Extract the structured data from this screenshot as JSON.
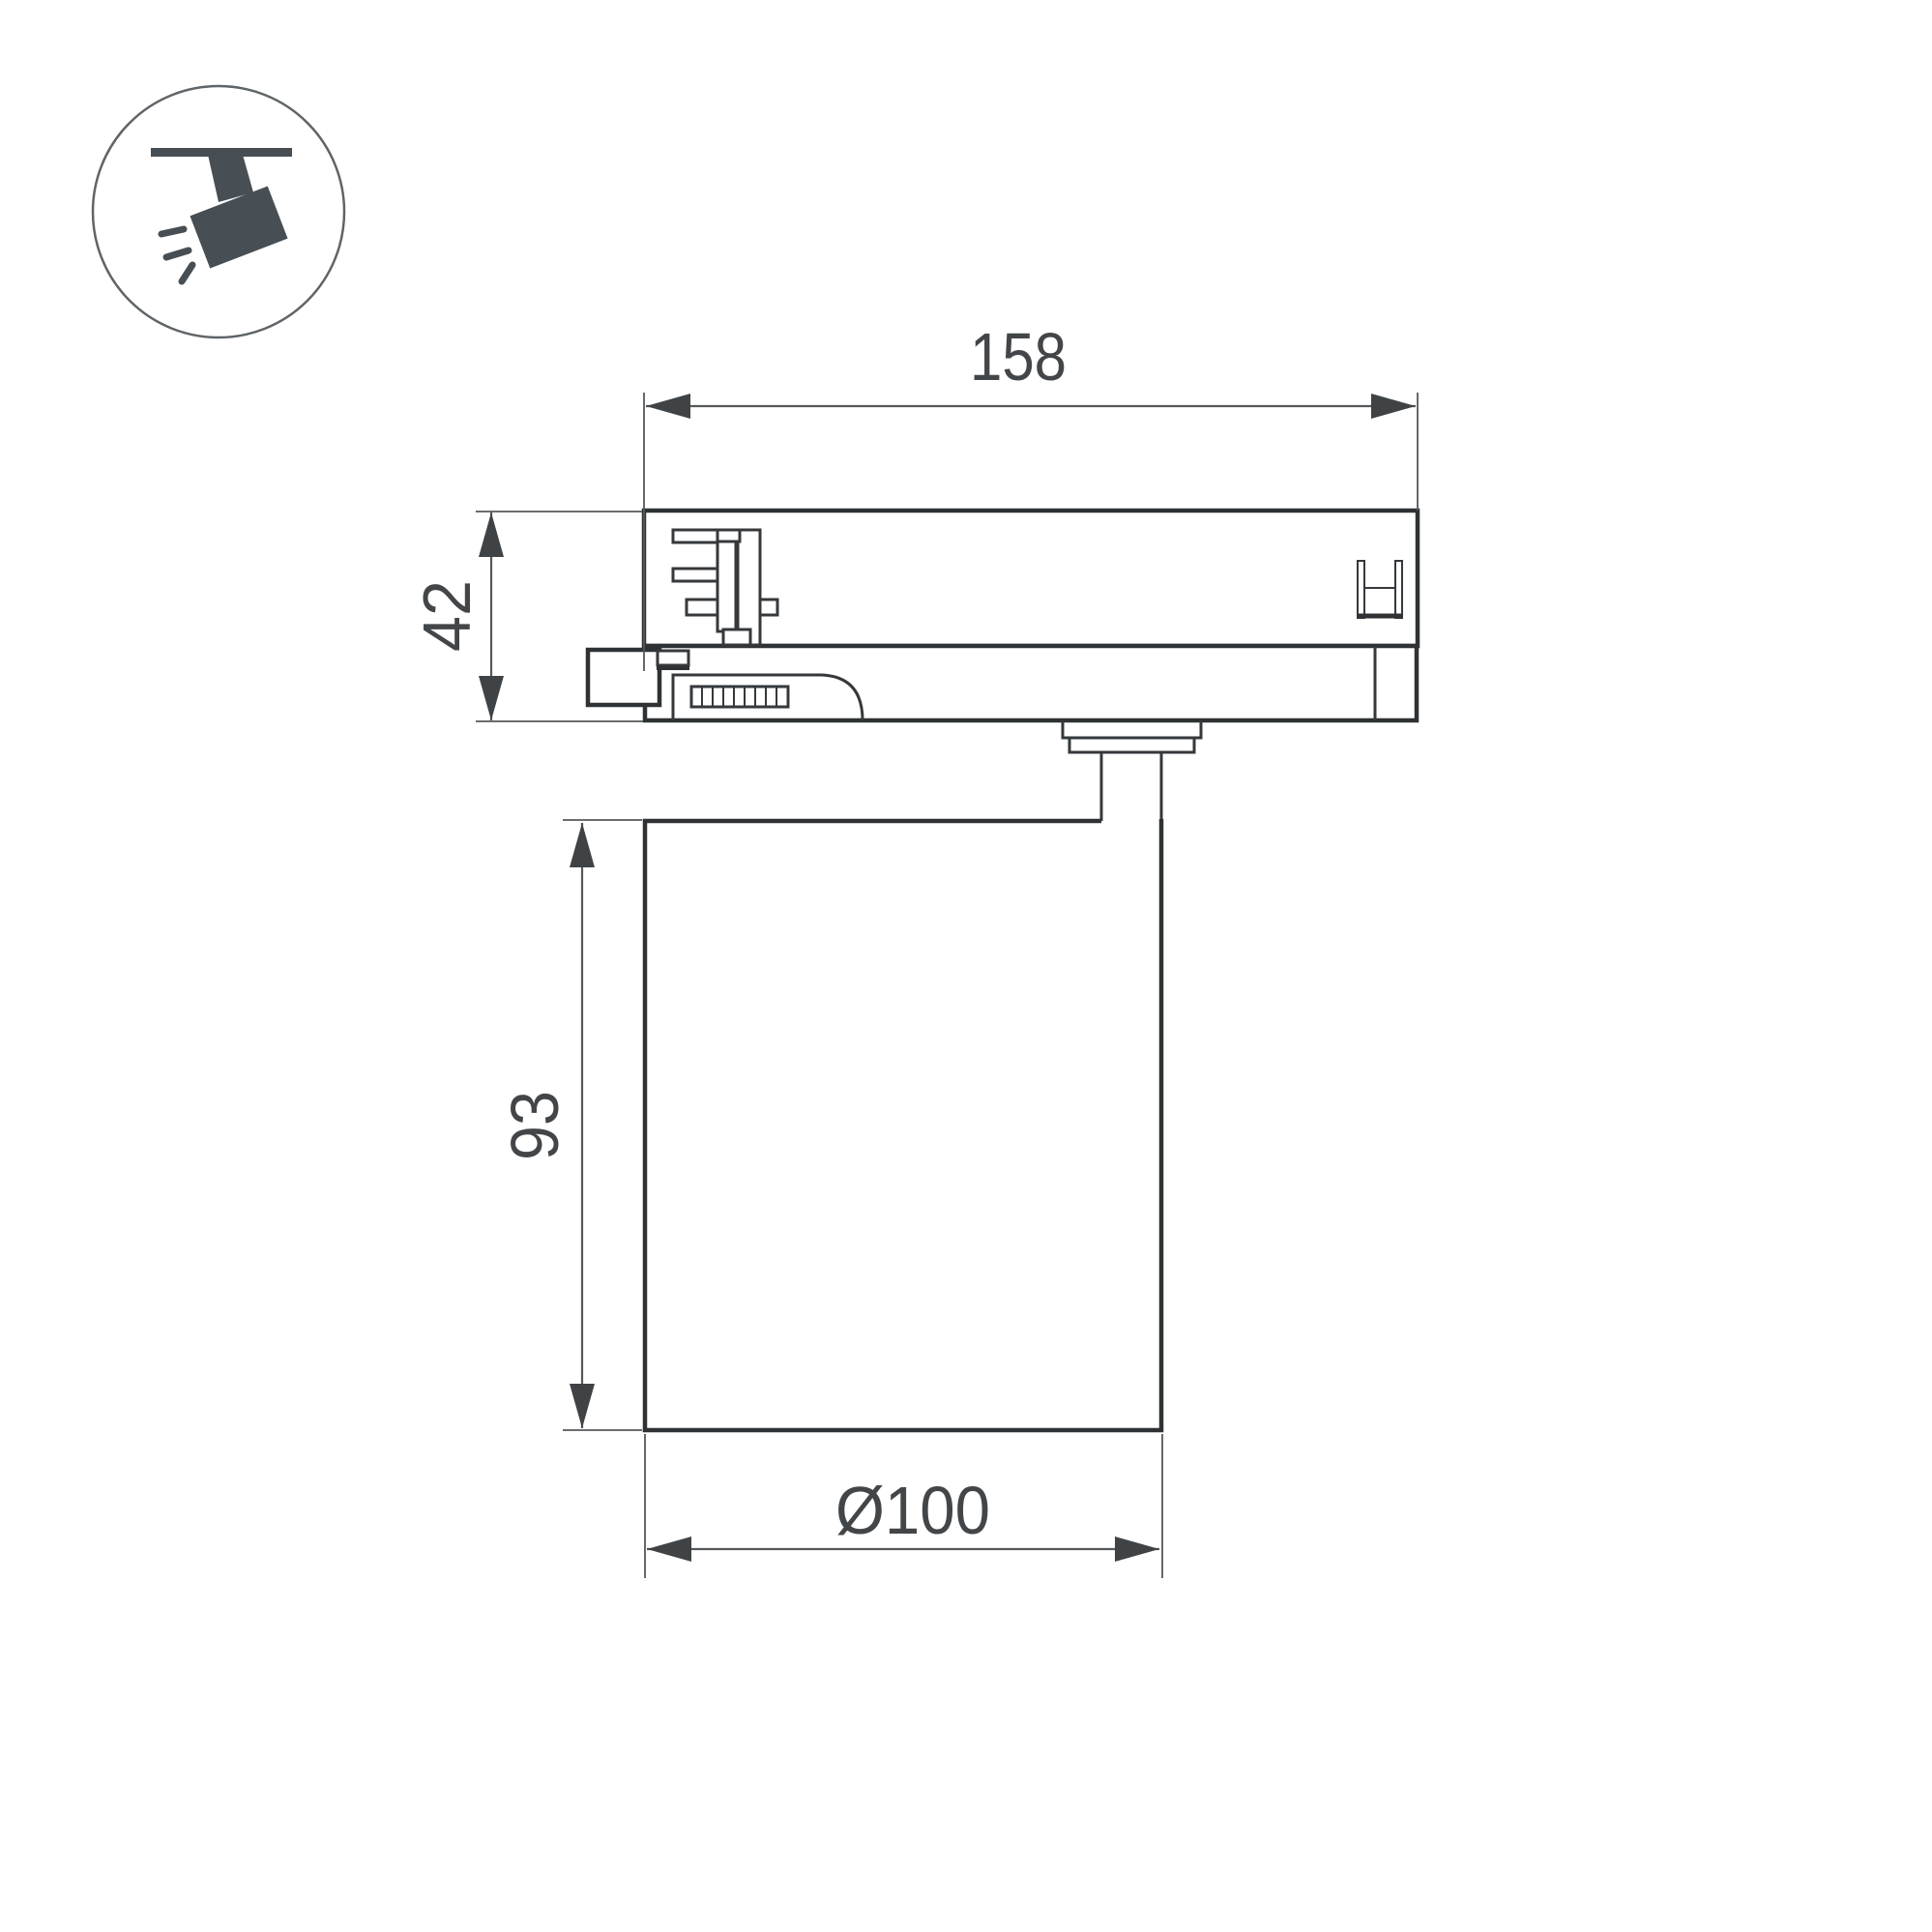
{
  "badge": {
    "icon": "track-spotlight-icon"
  },
  "drawing": {
    "dimensions": {
      "track_adapter_length": "158",
      "track_adapter_height": "42",
      "body_height": "93",
      "body_diameter": "Ø100"
    },
    "colors": {
      "outline": "#2f3235",
      "dimension_line": "#55585b",
      "dimension_text": "#434649",
      "icon_glyph": "#474e54",
      "background": "#ffffff"
    }
  }
}
